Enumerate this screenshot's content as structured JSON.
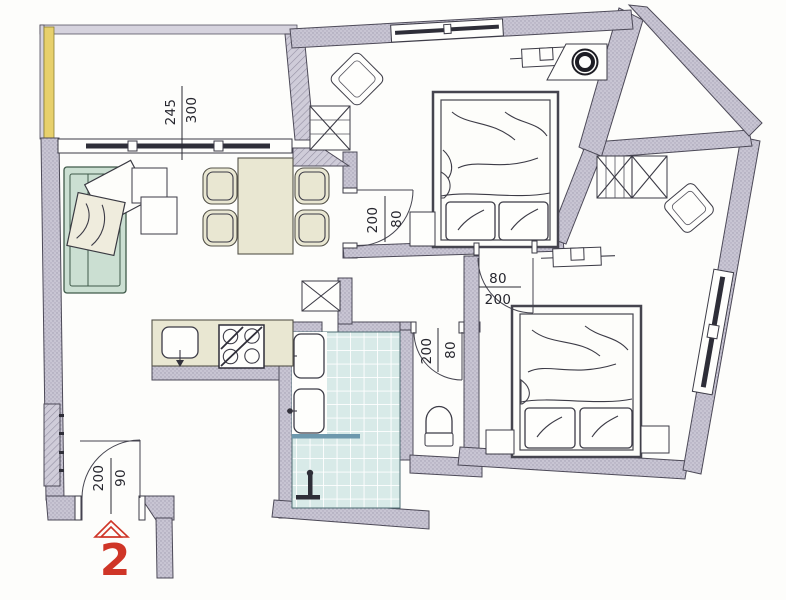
{
  "plan": {
    "kind": "apartment-floor-plan",
    "furniture": [
      "balcony",
      "sofa",
      "cushions",
      "coffee-tables",
      "dining-table",
      "dining-chairs",
      "storage-shaft",
      "kitchen-counter",
      "kitchen-sink",
      "stove",
      "bathroom-tiles",
      "wash-basin",
      "wash-basin",
      "shower",
      "toilet",
      "double-bed",
      "double-bed",
      "nightstand",
      "wardrobe",
      "wardrobe",
      "chair",
      "chair",
      "radiator",
      "boiler",
      "window",
      "door"
    ]
  },
  "dims": {
    "balcony": {
      "a": "300",
      "b": "245"
    }
  },
  "doors": {
    "entry": {
      "w": "90",
      "h": "200"
    },
    "bedroom1": {
      "w": "80",
      "h": "200"
    },
    "bedroom2": {
      "w": "80",
      "h": "200"
    },
    "wc": {
      "w": "80",
      "h": "200"
    }
  },
  "unit": {
    "number": "2"
  },
  "colors": {
    "wall": "#c8c5d3",
    "wall-dot": "#a19db0",
    "wall-light": "#d6d3de",
    "line": "#4d4a58",
    "ink": "#26262e",
    "yellow": "#e7d06c",
    "tile": "#d8eae8",
    "shelf-blue": "#6d98ad",
    "sofa": "#cbdfd2",
    "sofa-line": "#3f5a49",
    "beige": "#e9e7d2",
    "beige-light": "#efecdd",
    "red": "#cf3527",
    "dark": "#2e2e38"
  }
}
